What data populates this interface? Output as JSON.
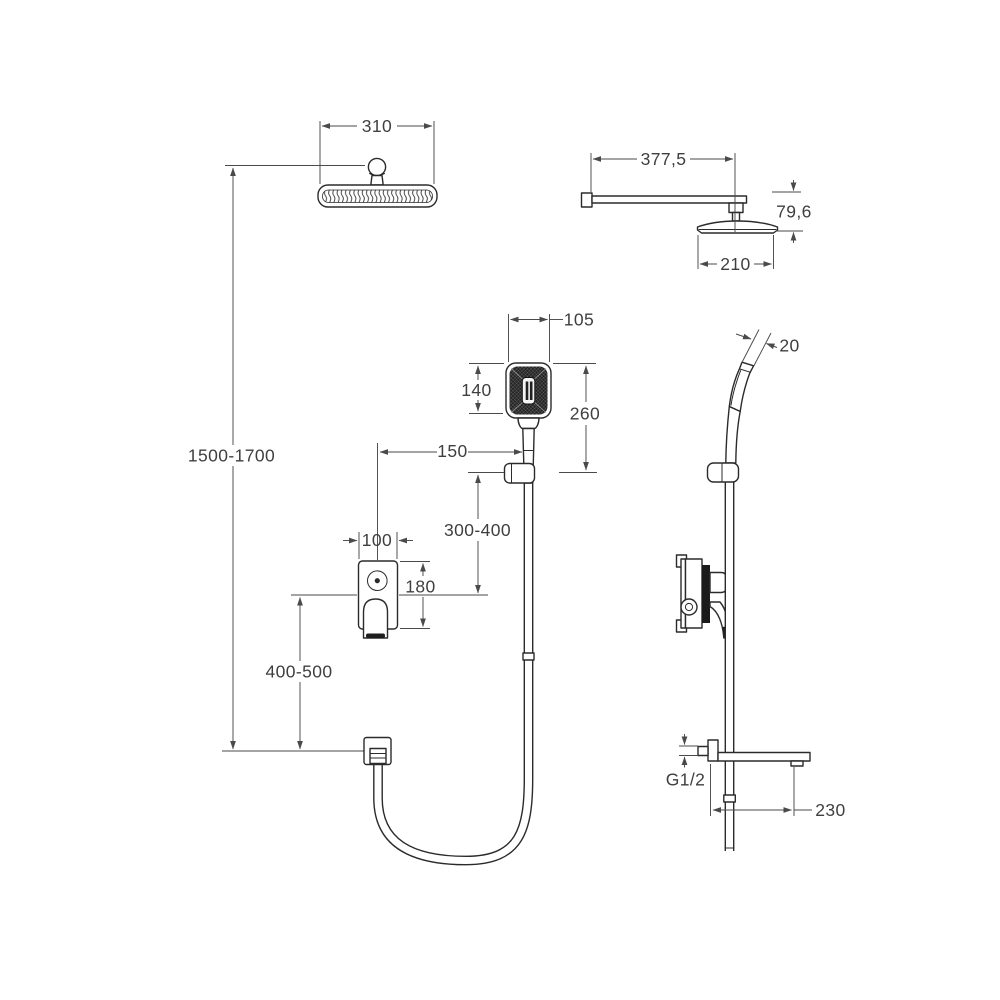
{
  "drawing": {
    "type": "shower-system-installation-dimensions",
    "dimensions": {
      "overhead_width": "310",
      "arm_length": "377,5",
      "head_drop": "79,6",
      "overhead_depth": "210",
      "handshower_width": "105",
      "handshower_head_height": "140",
      "handshower_length": "260",
      "handshower_thickness": "20",
      "mixer_offset": "150",
      "holder_to_mixer": "300-400",
      "mixer_width": "100",
      "mixer_height": "180",
      "install_height": "1500-1700",
      "mixer_to_outlet": "400-500",
      "thread": "G1/2",
      "spout_length": "230"
    },
    "line_color": "#2b2b2b",
    "dim_color": "#4a4a4a",
    "background": "#ffffff"
  }
}
